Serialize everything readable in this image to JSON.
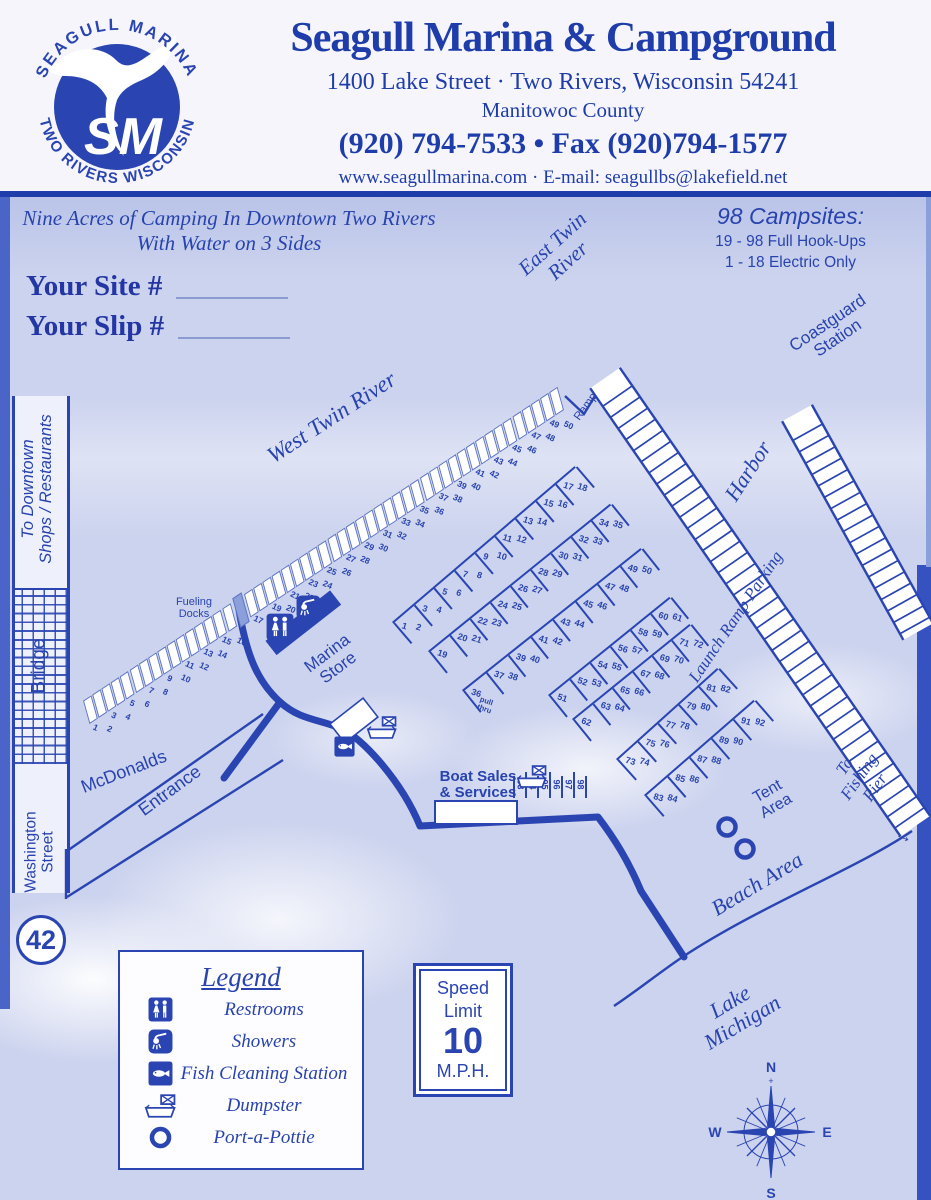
{
  "colors": {
    "brand_blue": "#1e3daa",
    "map_blue": "#2a45b2",
    "map_bg": "#ccd3ee"
  },
  "header": {
    "logo": {
      "top_text": "SEAGULL MARINA",
      "bottom_text": "TWO RIVERS WISCONSIN",
      "monogram": "SM"
    },
    "title": "Seagull Marina & Campground",
    "address": "1400 Lake Street · Two Rivers, Wisconsin 54241",
    "county": "Manitowoc County",
    "phone": "(920) 794-7533 • Fax (920)794-1577",
    "web": "www.seagullmarina.com · E-mail: seagullbs@lakefield.net"
  },
  "map": {
    "tagline_line1": "Nine Acres of Camping In Downtown Two Rivers",
    "tagline_line2": "With Water on 3 Sides",
    "site_label": "Your Site #",
    "slip_label": "Your Slip #",
    "campsites_info": {
      "title": "98 Campsites:",
      "line1": "19 - 98 Full Hook-Ups",
      "line2": "1 - 18 Electric Only"
    },
    "labels": {
      "east_twin_river": "East Twin\nRiver",
      "west_twin_river": "West Twin River",
      "coastguard_station": "Coastguard\nStation",
      "harbor": "Harbor",
      "launch_ramp_parking": "Launch Ramp Parking",
      "to_fishing_pier": "To Fishing Pier",
      "fishing_pier_arrow": "→",
      "tent_area": "Tent\nArea",
      "beach_area": "Beach Area",
      "lake_michigan": "Lake\nMichigan",
      "mcdonalds": "McDonalds",
      "entrance": "Entrance",
      "washington_street": "Washington\nStreet",
      "bridge": "Bridge",
      "to_downtown": "To Downtown\nShops / Restaurants",
      "marina_store": "Marina\nStore",
      "ramp": "Ramp",
      "fueling_docks": "Fueling\nDocks",
      "boat_sales": "Boat Sales\n& Services"
    },
    "route_badge": "42",
    "river_slips": {
      "first": 1,
      "last": 50,
      "fueling_dock_after": 16
    },
    "camp_rows": [
      {
        "id": "row-1-18",
        "from": 1,
        "to": 18
      },
      {
        "id": "row-19-35",
        "from": 19,
        "to": 35
      },
      {
        "id": "row-36-50",
        "from": 36,
        "to": 50,
        "first_note": "pull\nthru"
      },
      {
        "id": "row-51-61",
        "from": 51,
        "to": 61
      },
      {
        "id": "row-62-72",
        "from": 62,
        "to": 72
      },
      {
        "id": "row-73-82",
        "from": 73,
        "to": 82
      },
      {
        "id": "row-83-92",
        "from": 83,
        "to": 92
      },
      {
        "id": "row-93-98",
        "from": 93,
        "to": 98
      }
    ],
    "legend": {
      "title": "Legend",
      "items": [
        {
          "icon": "restrooms-icon",
          "label": "Restrooms"
        },
        {
          "icon": "showers-icon",
          "label": "Showers"
        },
        {
          "icon": "fish-cleaning-icon",
          "label": "Fish Cleaning Station"
        },
        {
          "icon": "dumpster-icon",
          "label": "Dumpster"
        },
        {
          "icon": "porta-pottie-icon",
          "label": "Port-a-Pottie"
        }
      ]
    },
    "speed_sign": {
      "line1": "Speed",
      "line2": "Limit",
      "value": "10",
      "unit": "M.P.H."
    },
    "compass": {
      "n": "N",
      "s": "S",
      "e": "E",
      "w": "W"
    }
  }
}
